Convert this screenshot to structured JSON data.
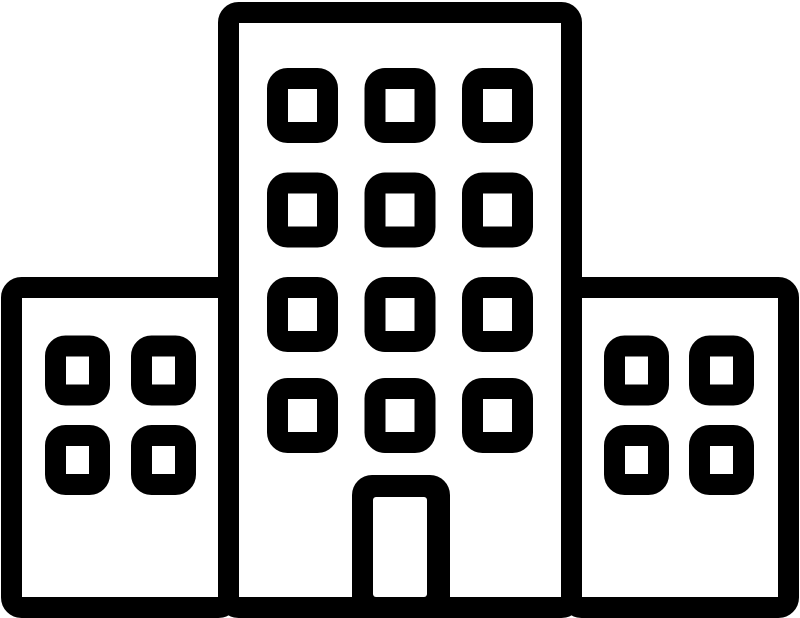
{
  "page": {
    "background_color": "#ffffff"
  },
  "icon": {
    "name": "building-icon",
    "alt": "Black outline icon of a building: a tall central tower with twelve windows and a door, flanked by a left wing and a right wing each with four windows, all standing on a common ground line",
    "stroke_color": "#000000",
    "fill_color": "#ffffff",
    "center_tower": {
      "window_rows": 4,
      "window_columns": 3,
      "has_door": true
    },
    "left_wing": {
      "window_rows": 2,
      "window_columns": 2
    },
    "right_wing": {
      "window_rows": 2,
      "window_columns": 2
    }
  }
}
